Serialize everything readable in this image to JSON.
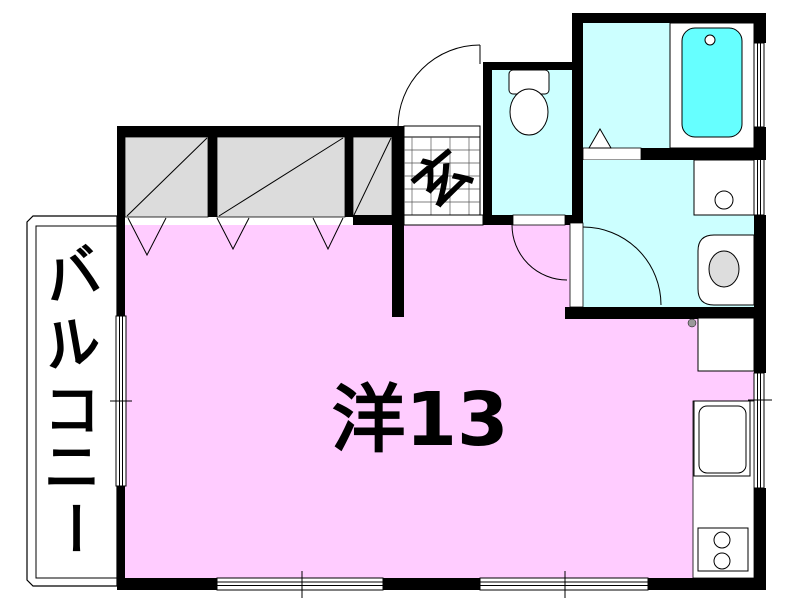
{
  "plan": {
    "type": "apartment-floor-plan",
    "rooms": {
      "main_room": {
        "label": "洋13",
        "color": "#FFCCFF"
      },
      "genkan": {
        "label": "玄",
        "color": "#FFFFFF"
      },
      "balcony": {
        "label": "バルコニー",
        "chars": [
          "バ",
          "ル",
          "コ",
          "ニ",
          "ー"
        ],
        "color": "#FFFFFF"
      },
      "toilet": {
        "color": "#CCFFFF"
      },
      "bathroom": {
        "color": "#CCFFFF",
        "tub_color": "#66FFFF"
      },
      "washroom": {
        "color": "#CCFFFF"
      },
      "closet": {
        "color": "#DCDCDC"
      }
    },
    "colors": {
      "wall": "#000000",
      "background": "#FFFFFF",
      "fixture_fill": "#FFFFFF",
      "basin_gray": "#DDDDDD",
      "knob_gray": "#999999"
    }
  }
}
